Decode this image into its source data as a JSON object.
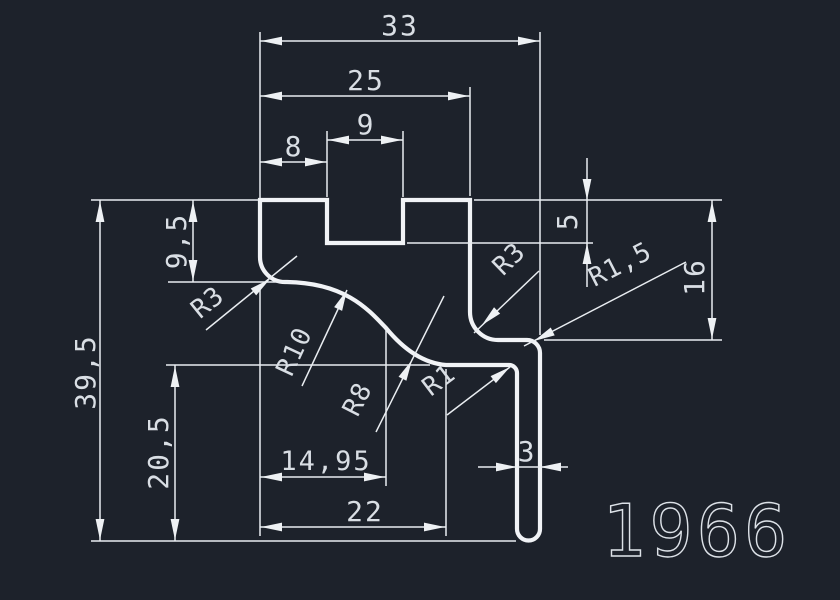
{
  "drawing_number": "1966",
  "colors": {
    "background": "#1d222b",
    "geometry_line": "#f1f3f6",
    "dimension_line": "#e9edf1",
    "text": "#d9dee4"
  },
  "dims": {
    "width_33": "33",
    "width_25": "25",
    "notch_width_9": "9",
    "offset_8": "8",
    "height_9_5": "9,5",
    "height_39_5": "39,5",
    "height_20_5": "20,5",
    "notch_depth_5": "5",
    "height_16": "16",
    "width_14_95": "14,95",
    "width_22": "22",
    "leg_width_3": "3",
    "radius_left_r3": "R3",
    "radius_r10": "R10",
    "radius_r8": "R8",
    "radius_r1": "R1",
    "radius_right_r3": "R3",
    "radius_r1_5": "R1,5"
  }
}
